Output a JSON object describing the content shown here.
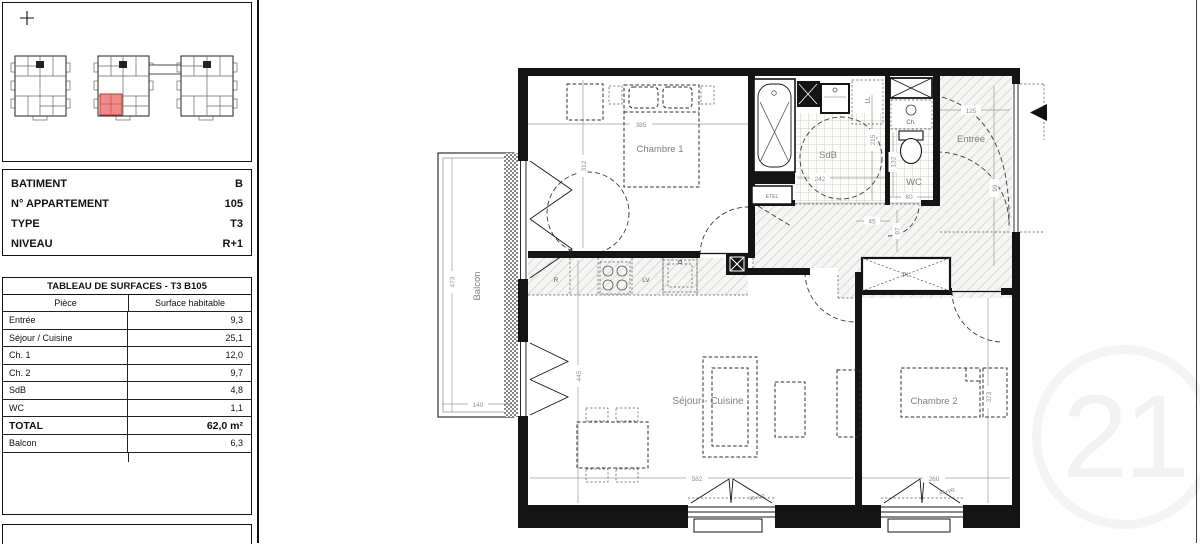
{
  "key_plan": {
    "compass": "+",
    "highlight_color": "#ef8a8a"
  },
  "info_table": {
    "rows": [
      {
        "label": "BATIMENT",
        "value": "B"
      },
      {
        "label": "N° APPARTEMENT",
        "value": "105"
      },
      {
        "label": "TYPE",
        "value": "T3"
      },
      {
        "label": "NIVEAU",
        "value": "R+1"
      }
    ]
  },
  "surface_table": {
    "title": "TABLEAU DE SURFACES - T3 B105",
    "col_piece": "Pièce",
    "col_surface": "Surface habitable",
    "rows": [
      {
        "piece": "Entrée",
        "surface": "9,3"
      },
      {
        "piece": "Séjour / Cuisine",
        "surface": "25,1"
      },
      {
        "piece": "Ch. 1",
        "surface": "12,0"
      },
      {
        "piece": "Ch. 2",
        "surface": "9,7"
      },
      {
        "piece": "SdB",
        "surface": "4,8"
      },
      {
        "piece": "WC",
        "surface": "1,1"
      }
    ],
    "total": {
      "piece": "TOTAL",
      "surface": "62,0 m²"
    },
    "annex": {
      "piece": "Balcon",
      "surface": "6,3"
    }
  },
  "plan": {
    "rooms": {
      "chambre1": "Chambre 1",
      "sdb": "SdB",
      "wc": "WC",
      "entree": "Entrée",
      "balcon": "Balcon",
      "sejour": "Séjour - Cuisine",
      "chambre2": "Chambre 2"
    },
    "fixtures": {
      "fridge": "R",
      "dishwasher": "LV",
      "washer": "LL",
      "etel": "ETEL",
      "heater": "Ch.",
      "closet": "Pl."
    },
    "dims": {
      "chambre1_w": "385",
      "chambre1_d": "312",
      "balcon_d": "473",
      "balcon_w": "140",
      "sdb_w": "242",
      "sdb_d": "215",
      "wc_w": "80",
      "wc_d": "132",
      "entree_w": "125",
      "entree_d": "99",
      "hall_w": "45",
      "hall_d": "97",
      "sejour_d": "445",
      "sejour_w": "582",
      "chambre2_d": "373",
      "chambre2_win": "260",
      "win_label_sejour": "95+VR",
      "win_label_chambre2": "95+VR"
    }
  },
  "watermark": "21"
}
